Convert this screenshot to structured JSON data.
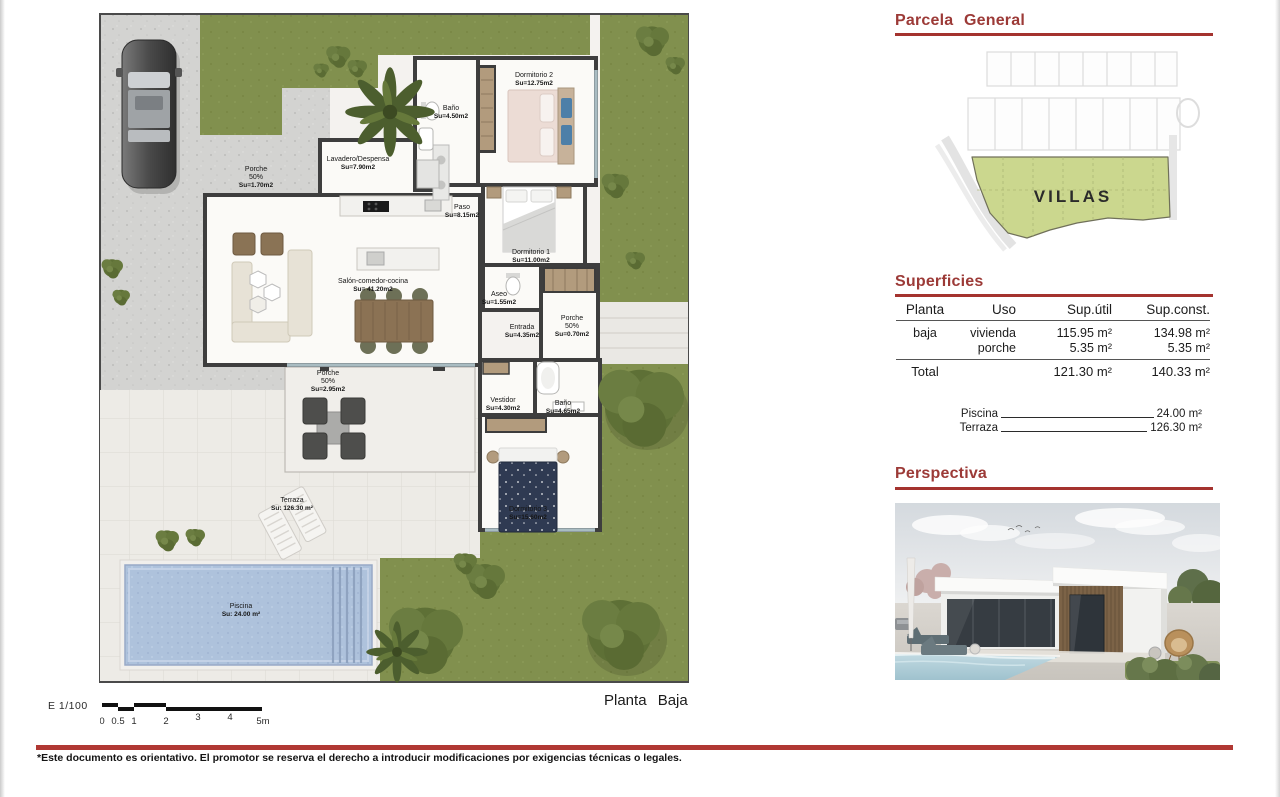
{
  "plan": {
    "title": "Planta Baja",
    "scale": {
      "label": "E 1/100",
      "ticks": [
        "0",
        "0.5",
        "1",
        "2",
        "3",
        "4",
        "5m"
      ]
    },
    "rooms": [
      {
        "name": "Porche",
        "pct": "50%",
        "area": "Su=1.70m2"
      },
      {
        "name": "Lavadero/Despensa",
        "area": "Su=7.90m2"
      },
      {
        "name": "Baño",
        "area": "Su=4.50m2"
      },
      {
        "name": "Dormitorio 2",
        "area": "Su=12.75m2"
      },
      {
        "name": "Paso",
        "area": "Su=8.15m2"
      },
      {
        "name": "Dormitorio 1",
        "area": "Su=11.00m2"
      },
      {
        "name": "Salón-comedor-cocina",
        "area": "Su= 41.20m2"
      },
      {
        "name": "Aseo",
        "area": "Su=1.55m2"
      },
      {
        "name": "Entrada",
        "area": "Su=4.35m2"
      },
      {
        "name": "Porche",
        "pct": "50%",
        "area": "Su=0.70m2"
      },
      {
        "name": "Porche",
        "pct": "50%",
        "area": "Su=2.95m2"
      },
      {
        "name": "Vestidor",
        "area": "Su=4.30m2"
      },
      {
        "name": "Baño",
        "area": "Su=4.65m2"
      },
      {
        "name": "Dormitorio 3",
        "area": "Su=15.60m2"
      },
      {
        "name": "Terraza",
        "area": "Su: 126.30 m²"
      },
      {
        "name": "Piscina",
        "area": "Su: 24.00 m²"
      }
    ]
  },
  "parcela": {
    "title": "Parcela General",
    "villas_label": "VILLAS"
  },
  "superficies": {
    "title": "Superficies",
    "headers": [
      "Planta",
      "Uso",
      "Sup.útil",
      "Sup.const."
    ],
    "rows": [
      {
        "planta": "baja",
        "uso": "vivienda",
        "sup_util": "115.95 m²",
        "sup_const": "134.98 m²"
      },
      {
        "planta": "",
        "uso": "porche",
        "sup_util": "5.35 m²",
        "sup_const": "5.35 m²"
      }
    ],
    "total": {
      "label": "Total",
      "sup_util": "121.30 m²",
      "sup_const": "140.33 m²"
    },
    "extras": [
      {
        "label": "Piscina",
        "value": "24.00 m²"
      },
      {
        "label": "Terraza",
        "value": "126.30 m²"
      }
    ]
  },
  "perspectiva": {
    "title": "Perspectiva"
  },
  "footer": {
    "disclaimer": "*Este documento es orientativo. El promotor se reserva el derecho a introducir modificaciones por exigencias técnicas o legales."
  },
  "colors": {
    "accent_red": "#A4332F",
    "lawn_green": "#81904E",
    "parcela_green": "#CBD78E",
    "pool_blue": "#AEC2DC"
  }
}
